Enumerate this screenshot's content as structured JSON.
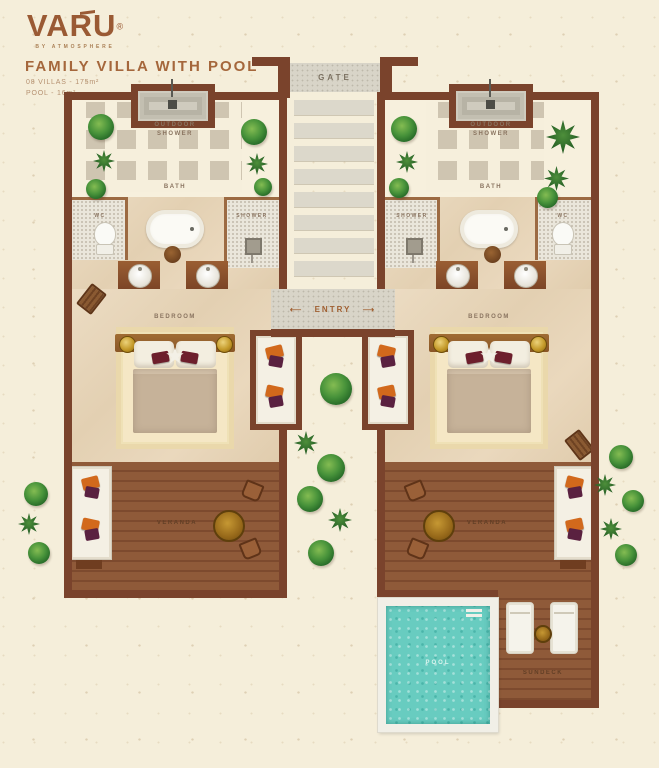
{
  "brand": {
    "logo": "VARU",
    "registered": "®",
    "tagline": "BY ATMOSPHERE"
  },
  "header": {
    "title": "FAMILY VILLA WITH POOL",
    "spec_villas": "08 VILLAS - 175m²",
    "spec_pool": "POOL - 16m²"
  },
  "plan": {
    "gate": "GATE",
    "entry": "ENTRY",
    "entry_arrow_left": "⟵",
    "entry_arrow_right": "⟶",
    "outdoor_shower": "OUTDOOR SHOWER",
    "bath": "BATH",
    "wc": "WC",
    "shower": "SHOWER",
    "bedroom": "BEDROOM",
    "veranda": "VERANDA",
    "pool": "POOL",
    "sundeck": "SUNDECK"
  },
  "colors": {
    "wall": "#7a432c",
    "accent_brown": "#a5673c",
    "deck": "#8f5a39",
    "pool_water": "#68ccc0",
    "cushion_orange": "#d2691c",
    "cushion_plum": "#5a2140",
    "background": "#f5eeda"
  }
}
